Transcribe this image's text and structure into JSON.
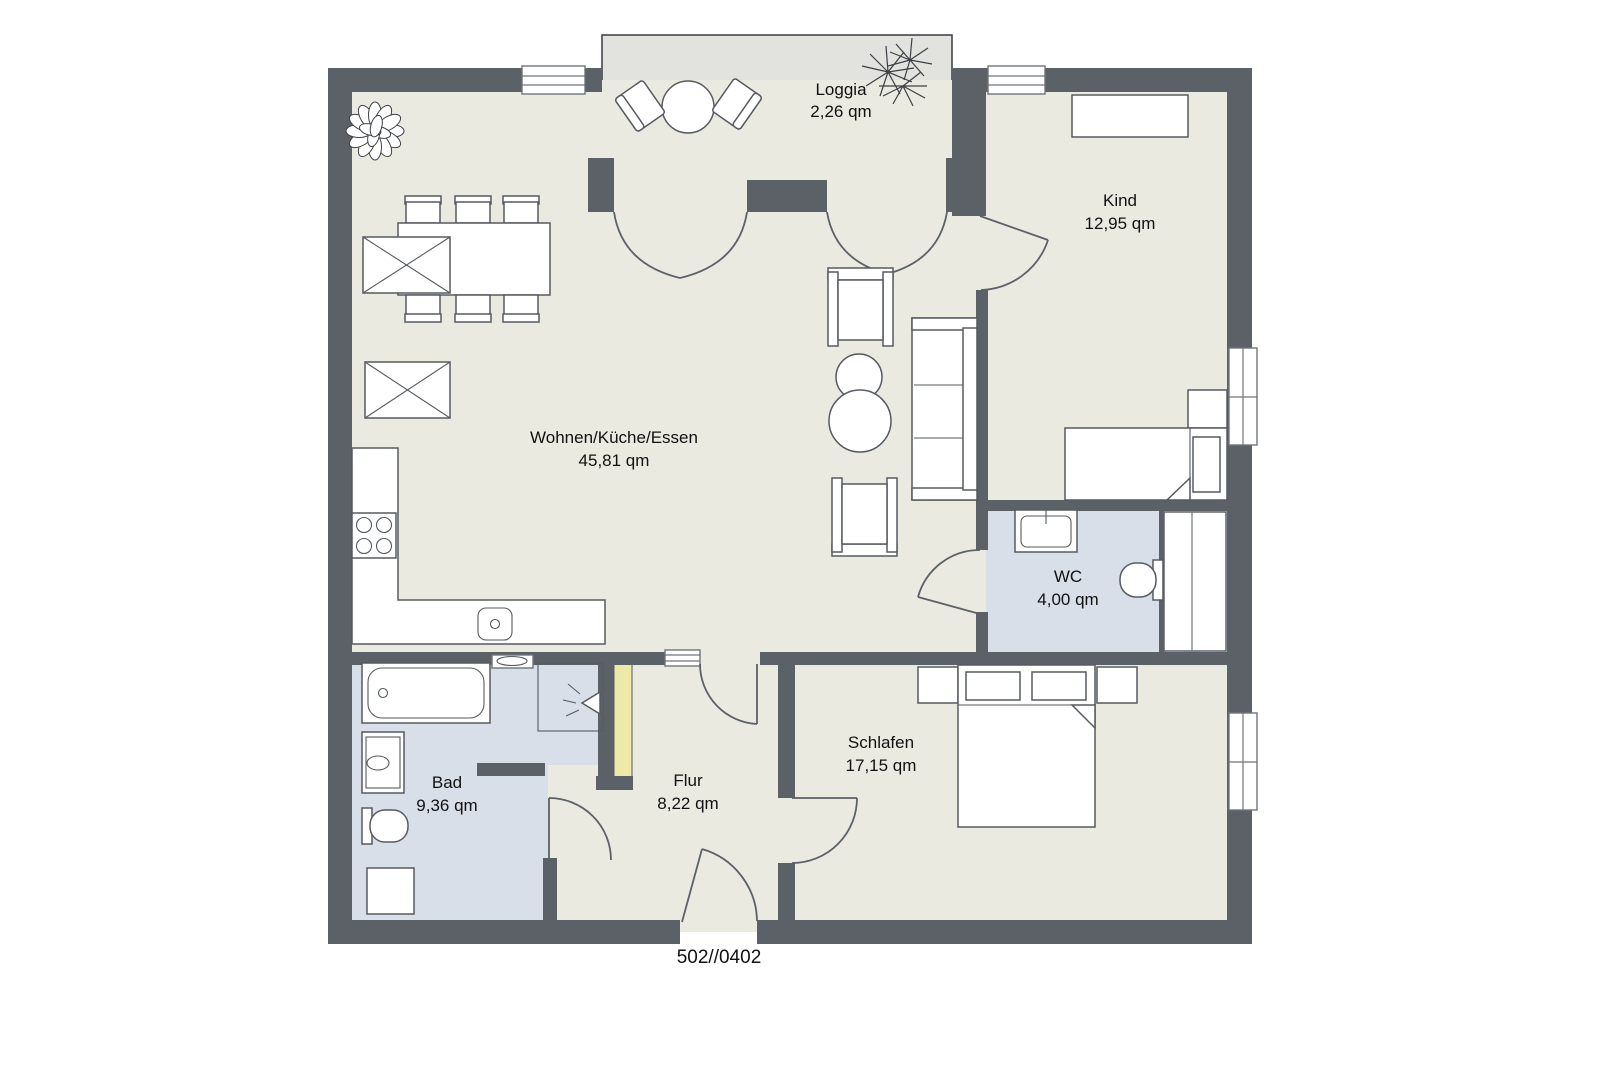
{
  "plan_label": "502//0402",
  "colors": {
    "wall": "#5c6167",
    "floor": "#eaeae1",
    "loggia_floor": "#e2e2df",
    "wet_floor": "#d9dfe9",
    "accent": "#ede9a7",
    "line": "#565b61",
    "window_line": "#70757b",
    "text": "#111111",
    "bg": "#ffffff",
    "loggia_outline": "#43484e"
  },
  "rooms": [
    {
      "id": "loggia",
      "name": "Loggia",
      "area": "2,26 qm"
    },
    {
      "id": "kind",
      "name": "Kind",
      "area": "12,95 qm"
    },
    {
      "id": "wohnen",
      "name": "Wohnen/Küche/Essen",
      "area": "45,81 qm"
    },
    {
      "id": "wc",
      "name": "WC",
      "area": "4,00 qm"
    },
    {
      "id": "schlafen",
      "name": "Schlafen",
      "area": "17,15 qm"
    },
    {
      "id": "bad",
      "name": "Bad",
      "area": "9,36 qm"
    },
    {
      "id": "flur",
      "name": "Flur",
      "area": "8,22 qm"
    }
  ]
}
